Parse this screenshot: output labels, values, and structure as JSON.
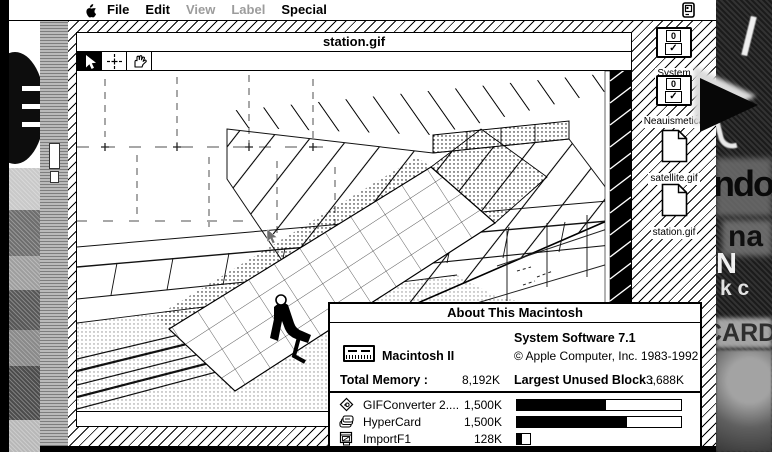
{
  "menu_bar": {
    "items": [
      {
        "label": "File",
        "enabled": true
      },
      {
        "label": "Edit",
        "enabled": true
      },
      {
        "label": "View",
        "enabled": false
      },
      {
        "label": "Label",
        "enabled": false
      },
      {
        "label": "Special",
        "enabled": true
      }
    ]
  },
  "desktop_icons": [
    {
      "label": "System",
      "kind": "floppy",
      "badge_top": "0",
      "badge_bottom": "✓"
    },
    {
      "label": "Neauismetica",
      "kind": "floppy",
      "badge_top": "0",
      "badge_bottom": "✓"
    },
    {
      "label": "satellite.gif",
      "kind": "document"
    },
    {
      "label": "station.gif",
      "kind": "document"
    }
  ],
  "image_window": {
    "title": "station.gif",
    "tools": [
      "arrow",
      "crosshair",
      "hand"
    ],
    "selected_tool": "arrow"
  },
  "about_window": {
    "title": "About This Macintosh",
    "computer": "Macintosh II",
    "system": "System Software 7.1",
    "copyright": "© Apple Computer, Inc. 1983-1992",
    "total_memory_label": "Total Memory :",
    "total_memory": "8,192K",
    "largest_block_label": "Largest Unused Block :",
    "largest_block": "3,688K",
    "processes": [
      {
        "name": "GIFConverter 2....",
        "memory": "1,500K",
        "bar_width_px": 166,
        "fill_pct": 54
      },
      {
        "name": "HyperCard",
        "memory": "1,500K",
        "bar_width_px": 166,
        "fill_pct": 67
      },
      {
        "name": "ImportF1",
        "memory": "128K",
        "bar_width_px": 15,
        "fill_pct": 40
      }
    ]
  },
  "background_fragments": {
    "text_ndo": "ndo",
    "text_na": "na",
    "text_n": "N",
    "text_kc": "k c",
    "text_card": "CARD"
  }
}
